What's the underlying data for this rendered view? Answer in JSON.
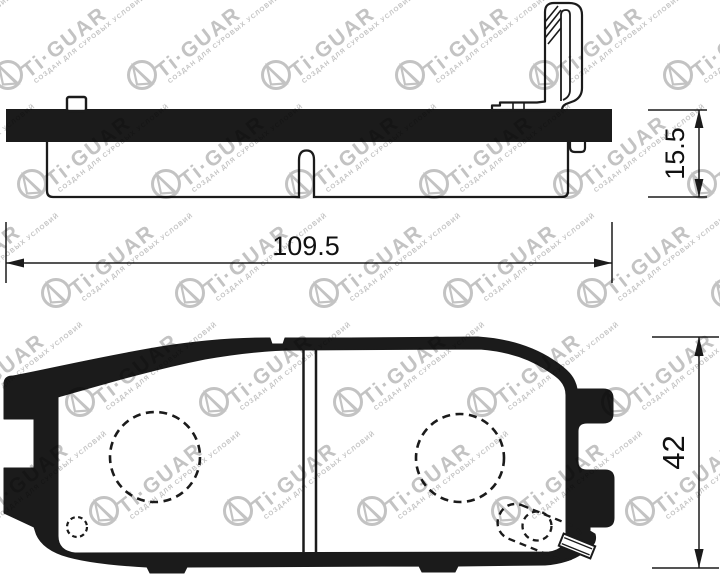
{
  "drawing": {
    "subject": "brake-pad-technical-drawing",
    "dimensions": {
      "width_label": "109.5",
      "thickness_label": "15.5",
      "height_label": "42"
    },
    "colors": {
      "ink": "#1b1b1b",
      "background": "#ffffff"
    }
  },
  "watermark": {
    "brand": "Ti·GUAR",
    "tagline": "СОЗДАН ДЛЯ СУРОВЫХ УСЛОВИЙ",
    "color": "#c3c3c3",
    "rows": 5,
    "cols": 6,
    "origin_x": 8,
    "origin_y": 75,
    "col_spacing": 134,
    "row_spacing": 109,
    "row_shift": 24,
    "angle_deg": -38
  }
}
